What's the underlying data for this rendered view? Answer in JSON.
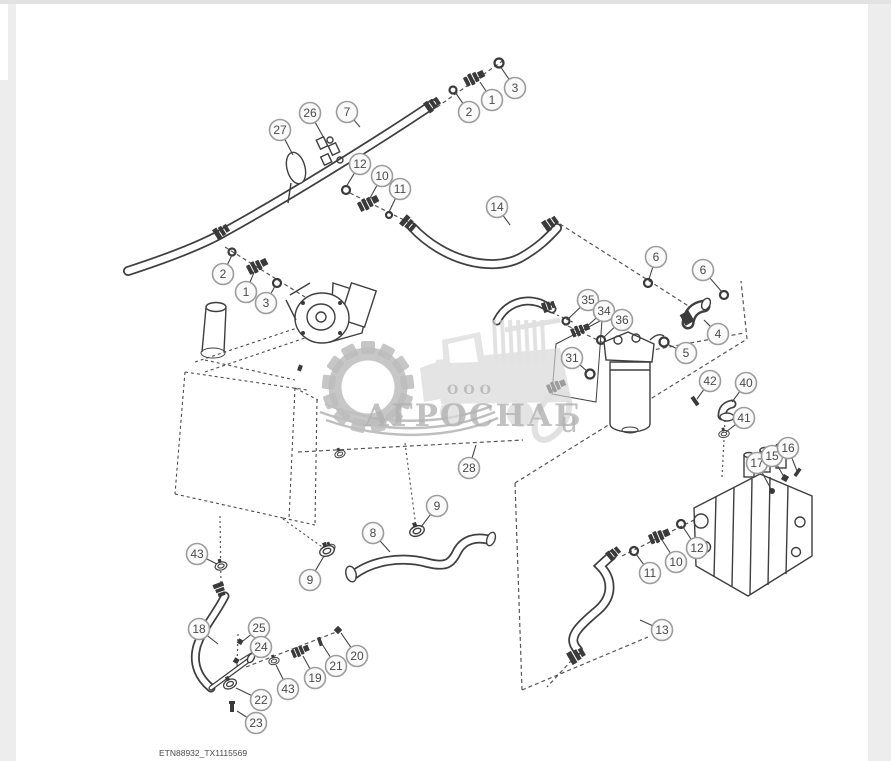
{
  "page": {
    "background": "#ededed",
    "paper_color": "#ffffff",
    "footer_label": "ETN88932_TX1115569"
  },
  "watermark": {
    "company_prefix": "ООО",
    "company_name": "АГРОСНАБ",
    "suffix": "u",
    "text_color": "#a4a4a4",
    "silhouette_color": "#d4d4d4"
  },
  "diagram": {
    "line_color": "#3f3f3f",
    "callout_style": {
      "radius": 10.5,
      "ring_color": "#9c9c9c",
      "fill": "#fafafa",
      "number_color": "#4a4a4a",
      "leader_color": "#444444"
    },
    "callouts": [
      {
        "label": "3",
        "x": 515,
        "y": 88,
        "tx": 500,
        "ty": 66
      },
      {
        "label": "1",
        "x": 492,
        "y": 100,
        "tx": 480,
        "ty": 82
      },
      {
        "label": "2",
        "x": 469,
        "y": 112,
        "tx": 455,
        "ty": 92
      },
      {
        "label": "26",
        "x": 310,
        "y": 113,
        "tx": 325,
        "ty": 140
      },
      {
        "label": "7",
        "x": 347,
        "y": 112,
        "tx": 360,
        "ty": 127
      },
      {
        "label": "27",
        "x": 280,
        "y": 130,
        "tx": 293,
        "ty": 155
      },
      {
        "label": "12",
        "x": 360,
        "y": 164,
        "tx": 346,
        "ty": 187
      },
      {
        "label": "10",
        "x": 382,
        "y": 176,
        "tx": 369,
        "ty": 200
      },
      {
        "label": "11",
        "x": 400,
        "y": 189,
        "tx": 389,
        "ty": 212
      },
      {
        "label": "14",
        "x": 497,
        "y": 207,
        "tx": 510,
        "ty": 225
      },
      {
        "label": "2",
        "x": 223,
        "y": 274,
        "tx": 232,
        "ty": 255
      },
      {
        "label": "1",
        "x": 246,
        "y": 292,
        "tx": 255,
        "ty": 270
      },
      {
        "label": "3",
        "x": 266,
        "y": 303,
        "tx": 275,
        "ty": 286
      },
      {
        "label": "6",
        "x": 656,
        "y": 257,
        "tx": 649,
        "ty": 279
      },
      {
        "label": "6",
        "x": 703,
        "y": 270,
        "tx": 722,
        "ty": 292
      },
      {
        "label": "35",
        "x": 588,
        "y": 300,
        "tx": 568,
        "ty": 319
      },
      {
        "label": "34",
        "x": 604,
        "y": 311,
        "tx": 585,
        "ty": 328
      },
      {
        "label": "36",
        "x": 622,
        "y": 320,
        "tx": 603,
        "ty": 338
      },
      {
        "label": "4",
        "x": 718,
        "y": 334,
        "tx": 704,
        "ty": 320
      },
      {
        "label": "5",
        "x": 686,
        "y": 353,
        "tx": 667,
        "ty": 344
      },
      {
        "label": "31",
        "x": 572,
        "y": 358,
        "tx": 588,
        "ty": 372
      },
      {
        "label": "42",
        "x": 710,
        "y": 381,
        "tx": 697,
        "ty": 399
      },
      {
        "label": "40",
        "x": 746,
        "y": 383,
        "tx": 732,
        "ty": 402
      },
      {
        "label": "41",
        "x": 744,
        "y": 418,
        "tx": 726,
        "ty": 432
      },
      {
        "label": "28",
        "x": 469,
        "y": 468,
        "tx": 476,
        "ty": 445
      },
      {
        "label": "17",
        "x": 757,
        "y": 463,
        "tx": 771,
        "ty": 489
      },
      {
        "label": "15",
        "x": 772,
        "y": 456,
        "tx": 784,
        "ty": 477
      },
      {
        "label": "16",
        "x": 788,
        "y": 448,
        "tx": 797,
        "ty": 471
      },
      {
        "label": "12",
        "x": 697,
        "y": 548,
        "tx": 683,
        "ty": 527
      },
      {
        "label": "10",
        "x": 676,
        "y": 562,
        "tx": 662,
        "ty": 540
      },
      {
        "label": "11",
        "x": 650,
        "y": 573,
        "tx": 636,
        "ty": 554
      },
      {
        "label": "13",
        "x": 662,
        "y": 630,
        "tx": 640,
        "ty": 620
      },
      {
        "label": "43",
        "x": 197,
        "y": 554,
        "tx": 217,
        "ty": 564
      },
      {
        "label": "9",
        "x": 310,
        "y": 580,
        "tx": 324,
        "ty": 556
      },
      {
        "label": "8",
        "x": 373,
        "y": 533,
        "tx": 390,
        "ty": 552
      },
      {
        "label": "9",
        "x": 437,
        "y": 506,
        "tx": 421,
        "ty": 527
      },
      {
        "label": "18",
        "x": 199,
        "y": 629,
        "tx": 218,
        "ty": 644
      },
      {
        "label": "25",
        "x": 259,
        "y": 628,
        "tx": 243,
        "ty": 641
      },
      {
        "label": "24",
        "x": 261,
        "y": 647,
        "tx": 240,
        "ty": 660
      },
      {
        "label": "20",
        "x": 357,
        "y": 656,
        "tx": 341,
        "ty": 633
      },
      {
        "label": "21",
        "x": 336,
        "y": 666,
        "tx": 322,
        "ty": 644
      },
      {
        "label": "19",
        "x": 315,
        "y": 678,
        "tx": 303,
        "ty": 656
      },
      {
        "label": "43",
        "x": 288,
        "y": 689,
        "tx": 276,
        "ty": 665
      },
      {
        "label": "22",
        "x": 261,
        "y": 700,
        "tx": 236,
        "ty": 688
      },
      {
        "label": "23",
        "x": 256,
        "y": 723,
        "tx": 237,
        "ty": 711
      }
    ]
  }
}
